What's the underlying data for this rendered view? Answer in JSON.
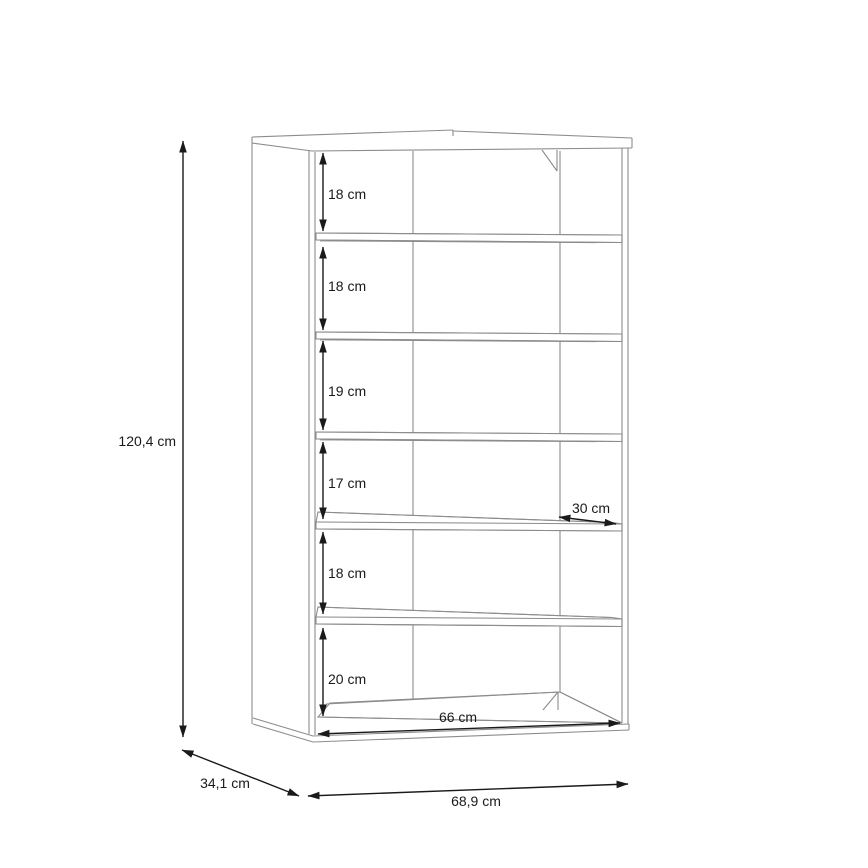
{
  "figure": {
    "kind": "furniture dimension line drawing",
    "subject": "open shelf cabinet with 6 compartments, perspective view",
    "unit": "cm"
  },
  "drawing": {
    "overall": {
      "height": "120,4 cm",
      "depth": "34,1 cm",
      "width": "68,9 cm"
    },
    "interior": {
      "width": "66 cm",
      "shelf_depth": "30 cm"
    },
    "compartments": [
      {
        "label": "18 cm"
      },
      {
        "label": "18 cm"
      },
      {
        "label": "19 cm"
      },
      {
        "label": "17 cm"
      },
      {
        "label": "18 cm"
      },
      {
        "label": "20 cm"
      }
    ],
    "colors": {
      "background": "#ffffff",
      "cabinet_line": "#8c8c8c",
      "dimension_line": "#1a1a1a"
    }
  }
}
